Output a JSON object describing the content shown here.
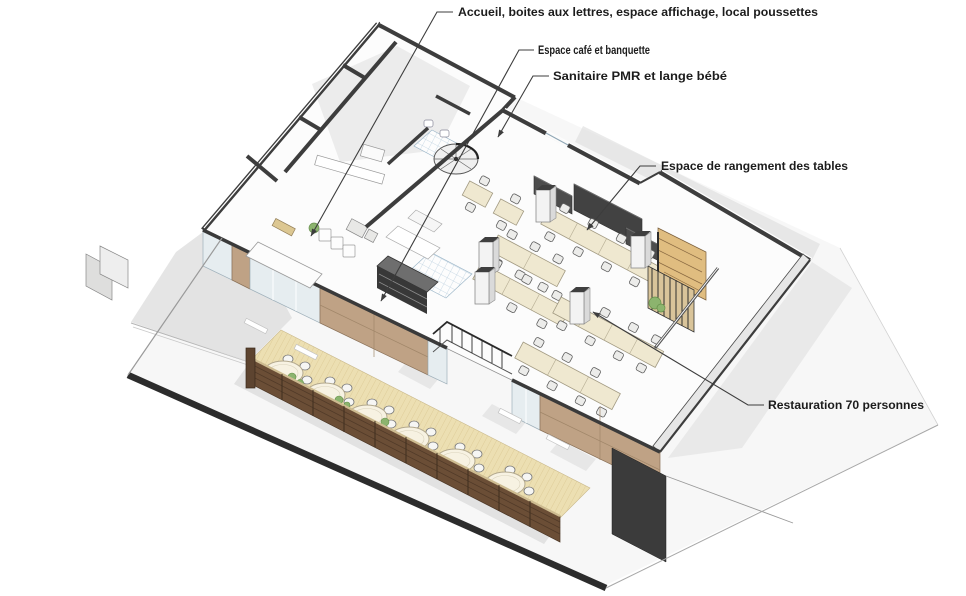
{
  "diagram": {
    "type": "axonometric-floor-plan",
    "annotations": [
      {
        "id": "accueil",
        "label": "Accueil, boites aux lettres, espace affichage, local poussettes"
      },
      {
        "id": "cafe",
        "label": "Espace café et banquette"
      },
      {
        "id": "sanitaire",
        "label": "Sanitaire PMR et lange bébé"
      },
      {
        "id": "rangement",
        "label": "Espace de rangement des tables"
      },
      {
        "id": "restauration",
        "label": "Restauration 70 personnes"
      }
    ],
    "palette": {
      "background": "#ffffff",
      "ground_edge": "#2c2c2c",
      "cut_wall": "#3d3d3d",
      "wood_facade": "#bfa285",
      "terrace_deck": "#ecdfb2",
      "terrace_fence": "#6b4e36",
      "dining_table": "#efe8d0",
      "tile_floor": "#b9cede",
      "plant": "#8cb46e",
      "label_text": "#1c1c1c"
    }
  }
}
